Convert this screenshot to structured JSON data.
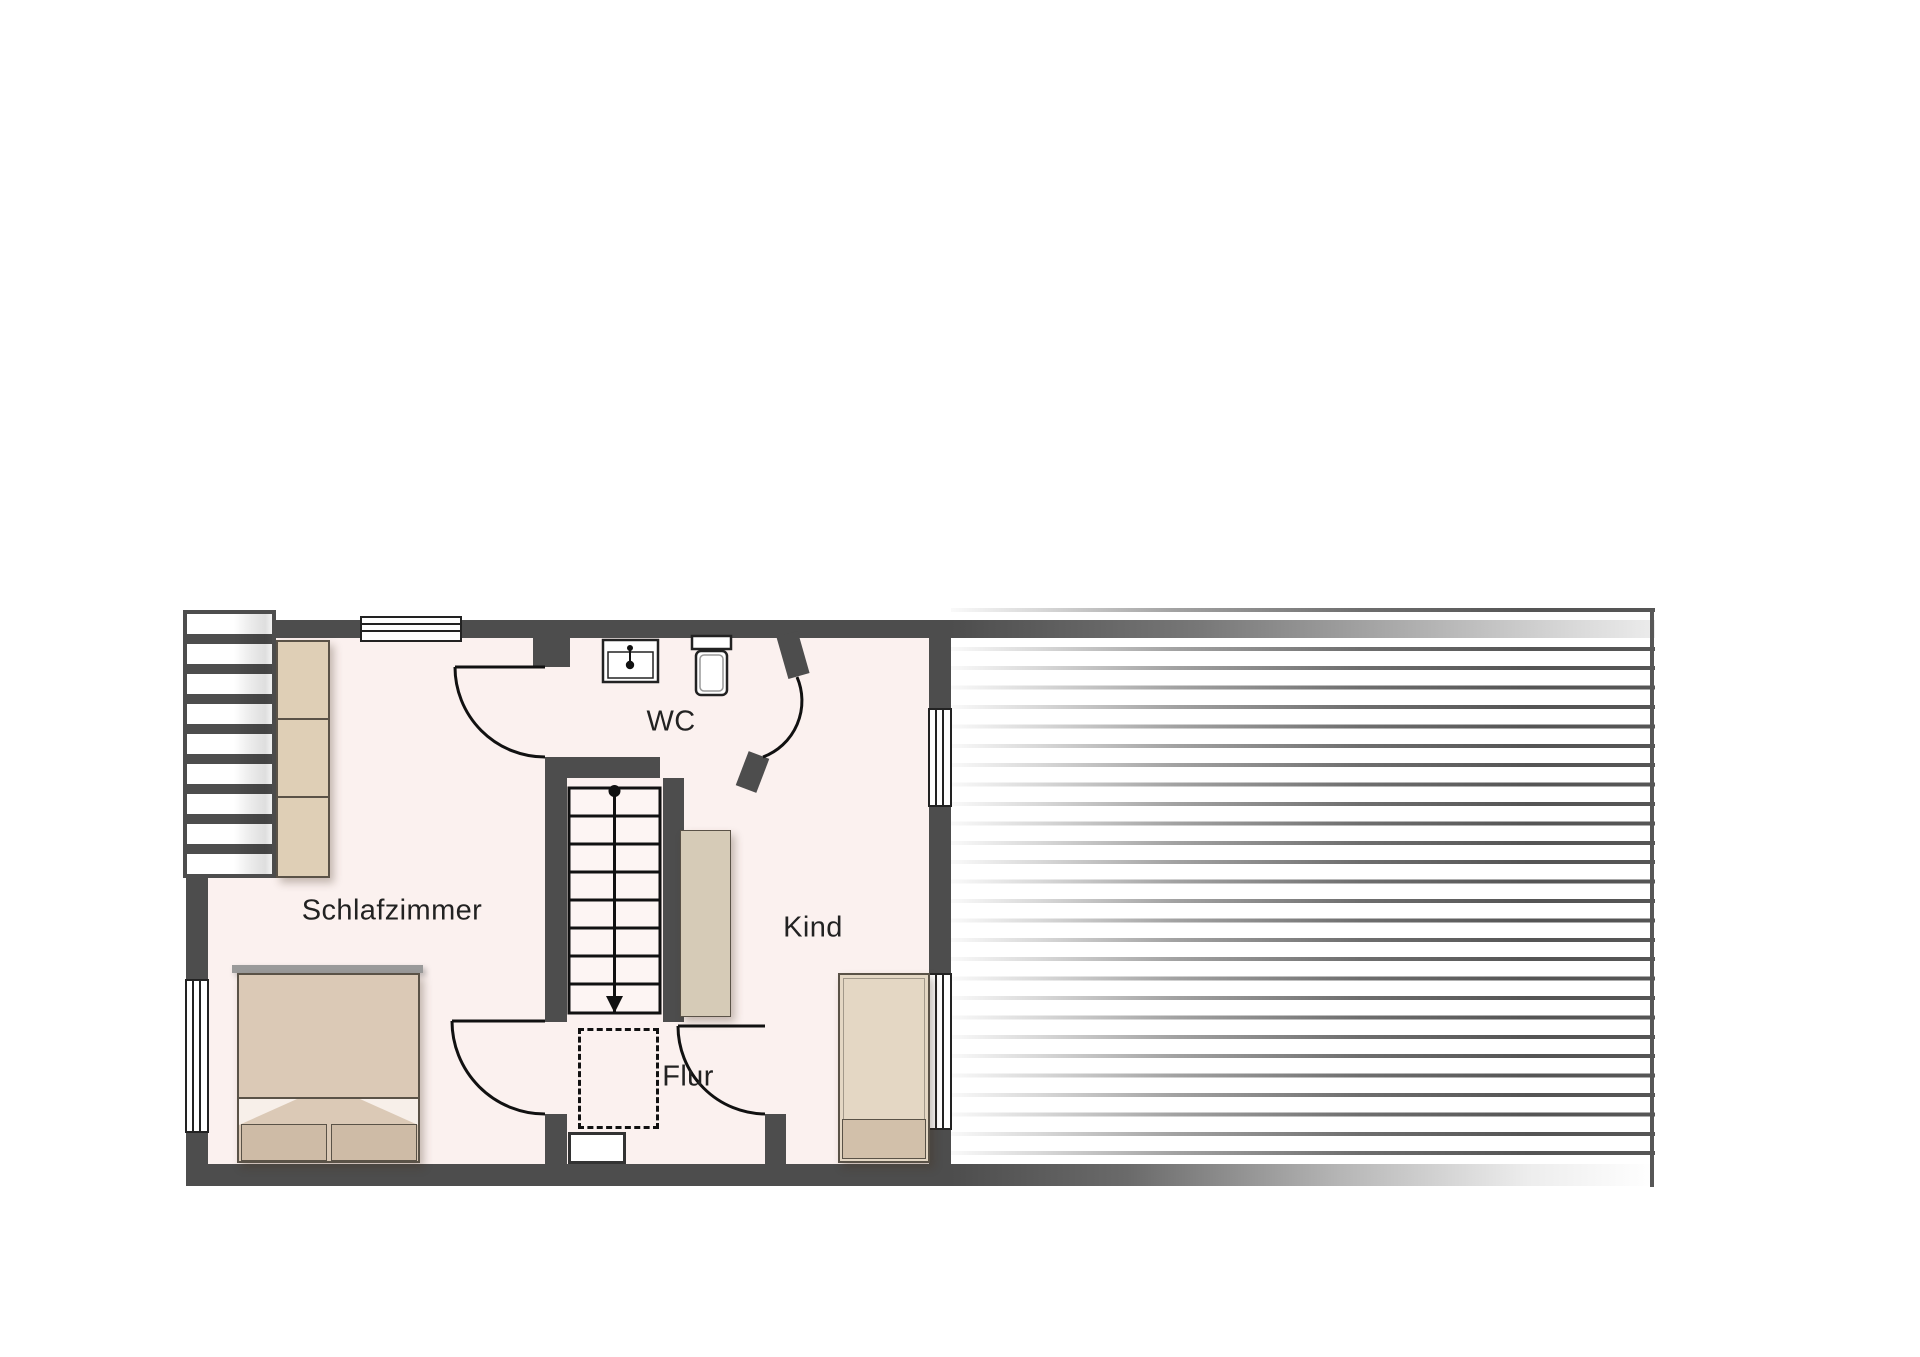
{
  "document": {
    "kind": "floor-plan",
    "floor": "attic"
  },
  "rooms": [
    {
      "id": "schlafzimmer",
      "label": "Schlafzimmer",
      "furniture": [
        "double-bed",
        "wardrobe"
      ]
    },
    {
      "id": "wc",
      "label": "WC",
      "furniture": [
        "sink",
        "toilet"
      ]
    },
    {
      "id": "kind",
      "label": "Kind",
      "furniture": [
        "single-bed",
        "wardrobe"
      ]
    },
    {
      "id": "flur",
      "label": "Flur",
      "furniture": []
    }
  ],
  "features": {
    "stairs": {
      "steps": 8,
      "walkline": "dot-to-arrow",
      "direction": "down"
    },
    "doors": 4,
    "windows": 5,
    "dormer_louver_window": true,
    "dashed_floor_opening": true,
    "roof_area": "horizontal-hatched with fade"
  },
  "theme": {
    "wall": "#4d4d4d",
    "floor": "#fbf1ef",
    "line": "#111111",
    "text": "#222222",
    "furnlight": "#dfcfb6",
    "furndark": "#cebba6"
  }
}
